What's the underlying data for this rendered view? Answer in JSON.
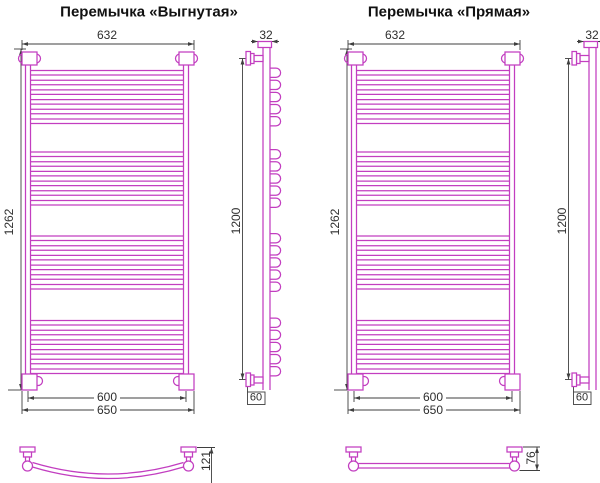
{
  "drawing": {
    "accent_color": "#c23ec0",
    "dim_color": "#3f3f3f",
    "figures": [
      {
        "id": "vygnutaya",
        "title": "Перемычка «Выгнутая»",
        "crossbar": "curved",
        "rung_groups": 4,
        "rungs_per_group": 6,
        "dims": {
          "top_width": "632",
          "cap_width": "32",
          "overall_height": "1262",
          "axis_height": "1200",
          "rail_spacing": "600",
          "overall_width": "650",
          "wall_offset": "60",
          "bar_depth": "121"
        }
      },
      {
        "id": "pryamaya",
        "title": "Перемычка «Прямая»",
        "crossbar": "straight",
        "rung_groups": 4,
        "rungs_per_group": 6,
        "dims": {
          "top_width": "632",
          "cap_width": "32",
          "overall_height": "1262",
          "axis_height": "1200",
          "rail_spacing": "600",
          "overall_width": "650",
          "wall_offset": "60",
          "bar_depth": "76"
        }
      }
    ]
  }
}
